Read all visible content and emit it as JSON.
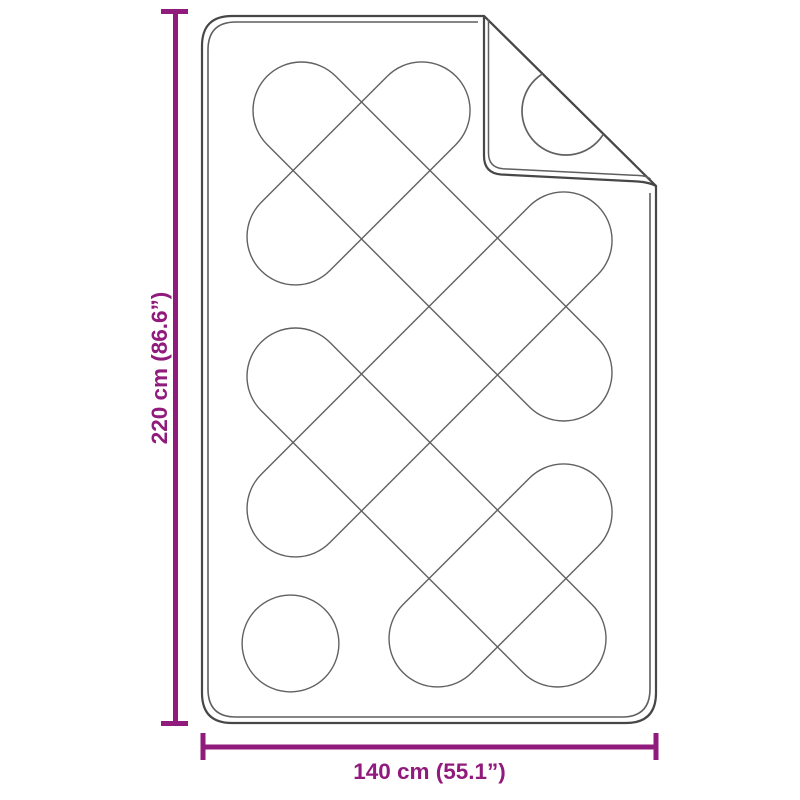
{
  "labels": {
    "height": "220 cm (86.6”)",
    "width": "140 cm (55.1”)"
  },
  "colors": {
    "dimension": "#911b7c",
    "outline": "#474747",
    "inner_line": "#5f5f5f",
    "pattern_line": "#616161",
    "background": "#ffffff"
  }
}
